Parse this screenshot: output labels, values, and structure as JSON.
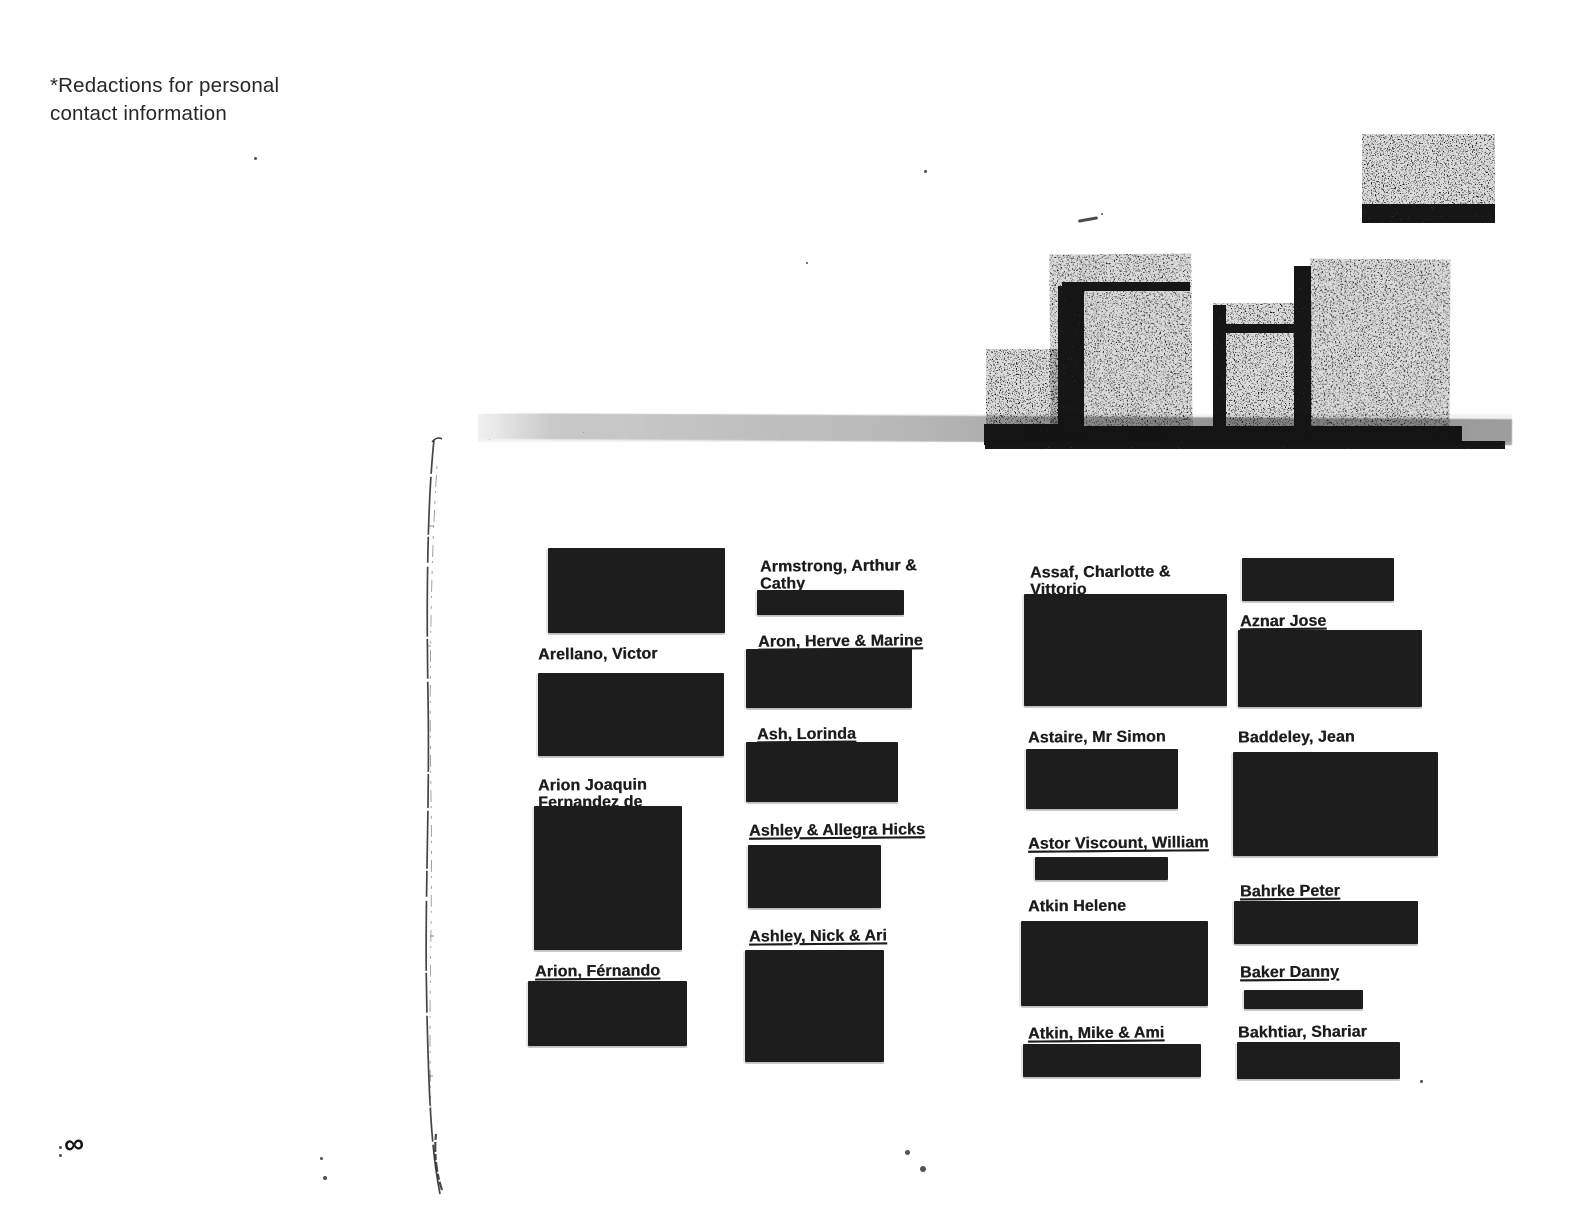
{
  "page": {
    "note_line1": "*Redactions for personal",
    "note_line2": "contact information",
    "page_marker": "∞"
  },
  "directory": {
    "description": "Scanned address book page, letter A-B entries, contact details redacted",
    "columns": [
      {
        "entries": [
          {
            "name": "",
            "redaction_box": {
              "x": 548,
              "y": 548,
              "w": 177,
              "h": 85
            }
          },
          {
            "name": "Arellano, Victor",
            "label": {
              "x": 538,
              "y": 646
            },
            "redaction_box": {
              "x": 538,
              "y": 673,
              "w": 186,
              "h": 83
            }
          },
          {
            "name": "Arion Joaquin\nFernandez de",
            "label": {
              "x": 538,
              "y": 777
            },
            "redaction_box": {
              "x": 534,
              "y": 806,
              "w": 148,
              "h": 144
            }
          },
          {
            "name": "Arion, Férnando",
            "label": {
              "x": 535,
              "y": 963
            },
            "underline": true,
            "redaction_box": {
              "x": 528,
              "y": 981,
              "w": 159,
              "h": 65
            }
          }
        ]
      },
      {
        "entries": [
          {
            "name": "Armstrong, Arthur &\nCathy",
            "label": {
              "x": 760,
              "y": 558
            },
            "redaction_box": {
              "x": 757,
              "y": 590,
              "w": 147,
              "h": 25
            }
          },
          {
            "name": "Aron, Herve & Marine",
            "label": {
              "x": 758,
              "y": 633
            },
            "underline": true,
            "redaction_box": {
              "x": 746,
              "y": 649,
              "w": 166,
              "h": 59
            }
          },
          {
            "name": "Ash, Lorinda",
            "label": {
              "x": 757,
              "y": 726
            },
            "underline": true,
            "redaction_box": {
              "x": 746,
              "y": 742,
              "w": 152,
              "h": 60
            }
          },
          {
            "name": "Ashley & Allegra Hicks",
            "label": {
              "x": 749,
              "y": 822
            },
            "underline": true,
            "redaction_box": {
              "x": 748,
              "y": 845,
              "w": 133,
              "h": 63
            }
          },
          {
            "name": "Ashley, Nick & Ari",
            "label": {
              "x": 749,
              "y": 928
            },
            "underline": true,
            "redaction_box": {
              "x": 745,
              "y": 950,
              "w": 139,
              "h": 112
            }
          }
        ]
      },
      {
        "entries": [
          {
            "name": "Assaf, Charlotte &\nVittorio",
            "label": {
              "x": 1030,
              "y": 564
            },
            "redaction_box": {
              "x": 1024,
              "y": 594,
              "w": 203,
              "h": 112
            }
          },
          {
            "name": "Astaire, Mr Simon",
            "label": {
              "x": 1028,
              "y": 729
            },
            "redaction_box": {
              "x": 1026,
              "y": 749,
              "w": 152,
              "h": 60
            }
          },
          {
            "name": "Astor Viscount, William",
            "label": {
              "x": 1028,
              "y": 835
            },
            "underline": true,
            "redaction_box": {
              "x": 1035,
              "y": 857,
              "w": 133,
              "h": 23
            }
          },
          {
            "name": "Atkin Helene",
            "label": {
              "x": 1028,
              "y": 898
            },
            "redaction_box": {
              "x": 1021,
              "y": 921,
              "w": 187,
              "h": 85
            }
          },
          {
            "name": "Atkin, Mike & Ami",
            "label": {
              "x": 1028,
              "y": 1025
            },
            "underline": true,
            "redaction_box": {
              "x": 1023,
              "y": 1044,
              "w": 178,
              "h": 33
            }
          }
        ]
      },
      {
        "entries": [
          {
            "name": "",
            "redaction_box": {
              "x": 1242,
              "y": 558,
              "w": 152,
              "h": 43
            }
          },
          {
            "name": "Aznar Jose",
            "label": {
              "x": 1240,
              "y": 613
            },
            "underline": true,
            "redaction_box": {
              "x": 1238,
              "y": 630,
              "w": 184,
              "h": 77
            }
          },
          {
            "name": "Baddeley, Jean",
            "label": {
              "x": 1238,
              "y": 729
            },
            "redaction_box": {
              "x": 1233,
              "y": 752,
              "w": 205,
              "h": 104
            }
          },
          {
            "name": "Bahrke Peter",
            "label": {
              "x": 1240,
              "y": 883
            },
            "underline": true,
            "redaction_box": {
              "x": 1234,
              "y": 901,
              "w": 184,
              "h": 43
            }
          },
          {
            "name": "Baker Danny",
            "label": {
              "x": 1240,
              "y": 964
            },
            "underline": true,
            "redaction_box": {
              "x": 1244,
              "y": 990,
              "w": 119,
              "h": 19
            }
          },
          {
            "name": "Bakhtiar, Shariar",
            "label": {
              "x": 1238,
              "y": 1024
            },
            "redaction_box": {
              "x": 1237,
              "y": 1042,
              "w": 163,
              "h": 37
            }
          }
        ]
      }
    ]
  },
  "scan_artifacts": {
    "noise_blocks": [
      {
        "x": 1362,
        "y": 134,
        "w": 133,
        "h": 82,
        "density": "med"
      },
      {
        "x": 1362,
        "y": 204,
        "w": 133,
        "h": 19,
        "density": "dark"
      },
      {
        "x": 986,
        "y": 349,
        "w": 74,
        "h": 93,
        "density": "med"
      },
      {
        "x": 984,
        "y": 424,
        "w": 80,
        "h": 21,
        "density": "dark"
      },
      {
        "x": 1050,
        "y": 254,
        "w": 142,
        "h": 192,
        "density": "med",
        "rot": -0.4
      },
      {
        "x": 1058,
        "y": 286,
        "w": 26,
        "h": 158,
        "density": "dark"
      },
      {
        "x": 1062,
        "y": 282,
        "w": 128,
        "h": 9,
        "density": "dark"
      },
      {
        "x": 1213,
        "y": 303,
        "w": 99,
        "h": 144,
        "density": "med"
      },
      {
        "x": 1213,
        "y": 305,
        "w": 13,
        "h": 142,
        "density": "dark"
      },
      {
        "x": 1222,
        "y": 324,
        "w": 88,
        "h": 9,
        "density": "dark"
      },
      {
        "x": 1294,
        "y": 266,
        "w": 17,
        "h": 181,
        "density": "dark"
      },
      {
        "x": 1310,
        "y": 259,
        "w": 140,
        "h": 188,
        "density": "med",
        "rot": 0.3
      },
      {
        "x": 1048,
        "y": 426,
        "w": 414,
        "h": 21,
        "density": "dark"
      },
      {
        "x": 985,
        "y": 441,
        "w": 520,
        "h": 8,
        "density": "dark"
      },
      {
        "x": 478,
        "y": 414,
        "w": 1034,
        "h": 28,
        "density": "light"
      },
      {
        "x": 1078,
        "y": 218,
        "w": 20,
        "h": 3,
        "density": "solid",
        "rot": -10
      }
    ],
    "specks": [
      {
        "x": 254,
        "y": 157,
        "s": 3
      },
      {
        "x": 905,
        "y": 1150,
        "s": 5
      },
      {
        "x": 920,
        "y": 1166,
        "s": 6
      },
      {
        "x": 1420,
        "y": 1080,
        "s": 3
      },
      {
        "x": 320,
        "y": 1157,
        "s": 3
      },
      {
        "x": 323,
        "y": 1176,
        "s": 4
      },
      {
        "x": 59,
        "y": 1146,
        "s": 3
      },
      {
        "x": 59,
        "y": 1154,
        "s": 3
      },
      {
        "x": 924,
        "y": 170,
        "s": 3
      },
      {
        "x": 806,
        "y": 262,
        "s": 2
      },
      {
        "x": 1101,
        "y": 213,
        "s": 2
      },
      {
        "x": 566,
        "y": 1012,
        "s": 2
      }
    ]
  }
}
